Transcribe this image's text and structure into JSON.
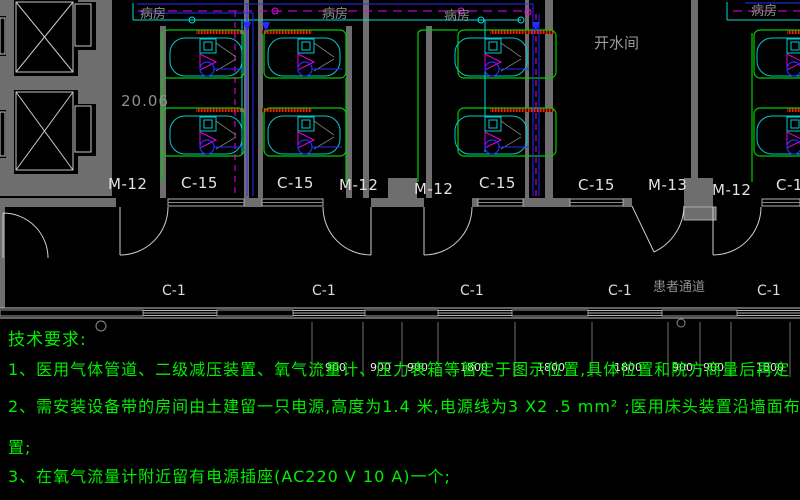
{
  "plan": {
    "labels": [
      {
        "name": "room-label-ward-1",
        "text": "病房",
        "x": 140,
        "y": 8,
        "cls": "g"
      },
      {
        "name": "room-label-ward-2",
        "text": "病房",
        "x": 322,
        "y": 8,
        "cls": "g"
      },
      {
        "name": "room-label-ward-3",
        "text": "病房",
        "x": 444,
        "y": 10,
        "cls": "g"
      },
      {
        "name": "room-label-ward-4",
        "text": "病房",
        "x": 751,
        "y": 5,
        "cls": "g"
      },
      {
        "name": "room-label-hot-water-room",
        "text": "开水间",
        "x": 594,
        "y": 36,
        "cls": "g2"
      },
      {
        "name": "room-label-patient-corridor",
        "text": "患者通道",
        "x": 653,
        "y": 281,
        "cls": "g"
      },
      {
        "name": "elevation-marker",
        "text": "20.06",
        "x": 121,
        "y": 94,
        "cls": "m"
      },
      {
        "name": "door-label-m12-1",
        "text": "M-12",
        "x": 108,
        "y": 177,
        "cls": "w"
      },
      {
        "name": "window-label-c15-1",
        "text": "C-15",
        "x": 181,
        "y": 176,
        "cls": "w"
      },
      {
        "name": "window-label-c15-2",
        "text": "C-15",
        "x": 277,
        "y": 176,
        "cls": "w"
      },
      {
        "name": "door-label-m12-2",
        "text": "M-12",
        "x": 339,
        "y": 178,
        "cls": "w"
      },
      {
        "name": "door-label-m12-3",
        "text": "M-12",
        "x": 414,
        "y": 182,
        "cls": "w"
      },
      {
        "name": "window-label-c15-3",
        "text": "C-15",
        "x": 479,
        "y": 176,
        "cls": "w"
      },
      {
        "name": "window-label-c15-4",
        "text": "C-15",
        "x": 578,
        "y": 178,
        "cls": "w"
      },
      {
        "name": "door-label-m13",
        "text": "M-13",
        "x": 648,
        "y": 178,
        "cls": "w"
      },
      {
        "name": "door-label-m12-4",
        "text": "M-12",
        "x": 712,
        "y": 183,
        "cls": "w"
      },
      {
        "name": "window-label-c15-5",
        "text": "C-15",
        "x": 776,
        "y": 178,
        "cls": "w"
      },
      {
        "name": "window-label-c1-1",
        "text": "C-1",
        "x": 162,
        "y": 284,
        "cls": "c"
      },
      {
        "name": "window-label-c1-2",
        "text": "C-1",
        "x": 312,
        "y": 284,
        "cls": "c"
      },
      {
        "name": "window-label-c1-3",
        "text": "C-1",
        "x": 460,
        "y": 284,
        "cls": "c"
      },
      {
        "name": "window-label-c1-4",
        "text": "C-1",
        "x": 608,
        "y": 284,
        "cls": "c"
      },
      {
        "name": "window-label-c1-5",
        "text": "C-1",
        "x": 757,
        "y": 284,
        "cls": "c"
      },
      {
        "name": "dim-label-1",
        "text": "900",
        "x": 325,
        "y": 362,
        "cls": "d"
      },
      {
        "name": "dim-label-2",
        "text": "900",
        "x": 370,
        "y": 362,
        "cls": "d"
      },
      {
        "name": "dim-label-3",
        "text": "900",
        "x": 407,
        "y": 362,
        "cls": "d"
      },
      {
        "name": "dim-label-4",
        "text": "1800",
        "x": 460,
        "y": 362,
        "cls": "d"
      },
      {
        "name": "dim-label-5",
        "text": "1800",
        "x": 537,
        "y": 362,
        "cls": "d"
      },
      {
        "name": "dim-label-6",
        "text": "1800",
        "x": 614,
        "y": 362,
        "cls": "d"
      },
      {
        "name": "dim-label-7",
        "text": "900",
        "x": 672,
        "y": 362,
        "cls": "d"
      },
      {
        "name": "dim-label-8",
        "text": "900",
        "x": 703,
        "y": 362,
        "cls": "d"
      },
      {
        "name": "dim-label-9",
        "text": "1800",
        "x": 756,
        "y": 362,
        "cls": "d"
      }
    ]
  },
  "notes": {
    "heading": "技术要求:",
    "line1": "1、医用气体管道、二级减压装置、氧气流量计、压力表箱等暂定于图示位置,具体位置和院方商量后再定",
    "line2": "2、需安装设备带的房间由土建留一只电源,高度为1.4 米,电源线为3 X2 .5 mm² ;医用床头装置沿墙面布",
    "line2_wrap": "置;",
    "line3": "3、在氧气流量计附近留有电源插座(AC220 V 10 A)一个;"
  },
  "colors": {
    "background": "#000000",
    "notes_text": "#00ef00",
    "gas_pipe_green": "#00cc00",
    "pipe_cyan": "#00dddd",
    "pipe_magenta": "#ee00ee",
    "pipe_blue": "#2a2aff",
    "equipment_band_red": "#ff2200",
    "wall_gray": "#6e6e6e",
    "line_white": "#c8c8c8"
  }
}
